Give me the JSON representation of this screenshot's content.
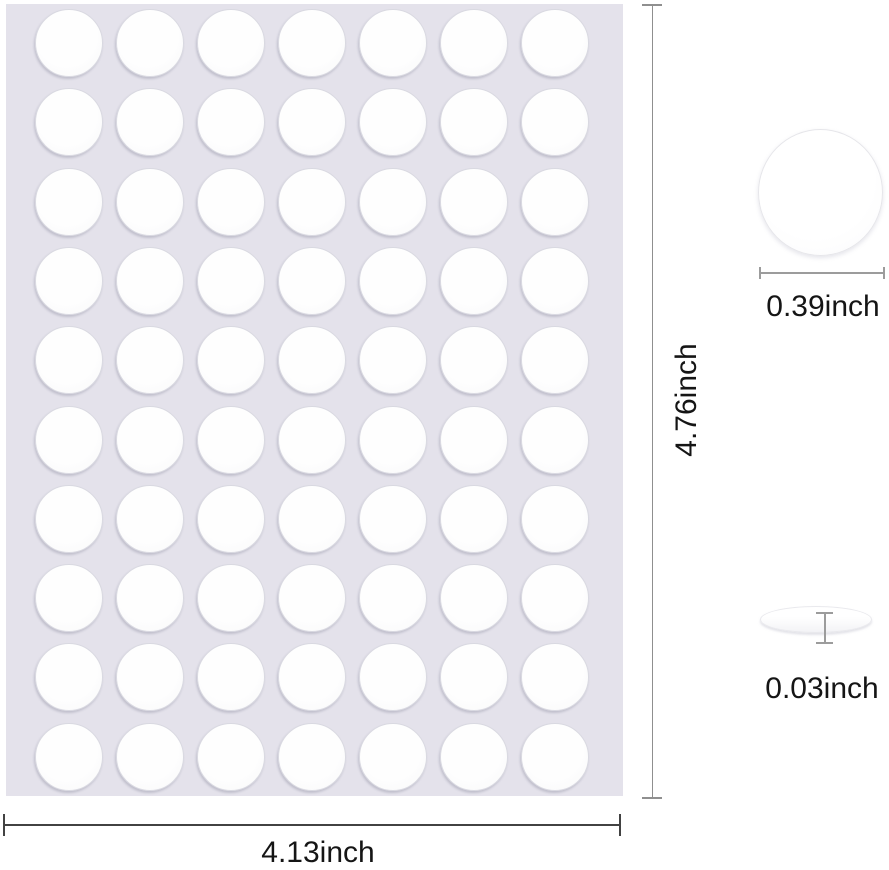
{
  "sheet": {
    "rows": 10,
    "cols": 7,
    "dot_total": 70,
    "sheet_color": "#e4e2eb",
    "dot_color": "#fdfdfe"
  },
  "labels": {
    "sheet_height": "4.76inch",
    "sheet_width": "4.13inch",
    "dot_diameter": "0.39inch",
    "dot_thickness": "0.03inch"
  },
  "colors": {
    "dimension_line": "#8f8f8f",
    "dimension_line_dark": "#424242",
    "text": "#151515"
  }
}
